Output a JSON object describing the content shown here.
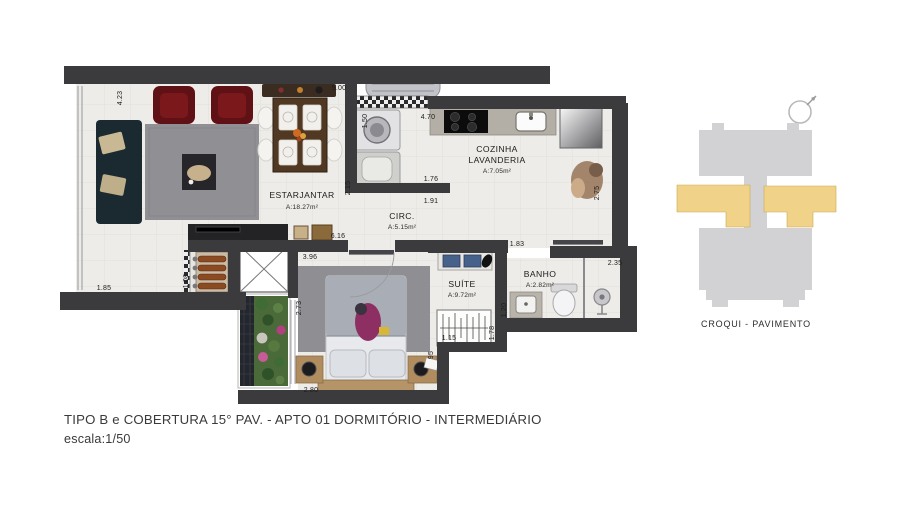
{
  "plan": {
    "rooms": [
      {
        "line1": "ESTARJANTAR",
        "area": "A:18.27m²"
      },
      {
        "line1": "COZINHA",
        "line2": "LAVANDERIA",
        "area": "A:7.05m²"
      },
      {
        "line1": "CIRC.",
        "area": "A:5.15m²"
      },
      {
        "line1": "SUÍTE",
        "area": "A:9.72m²"
      },
      {
        "line1": "BANHO",
        "area": "A:2.82m²"
      }
    ],
    "dims": [
      "4.23",
      "5.00",
      "1.50",
      "4.70",
      "2.15",
      "1.76",
      "1.91",
      "2.75",
      "6.16",
      "1.83",
      "3.96",
      "1.08",
      "1.85",
      "2.73",
      "2.35",
      "1.20",
      "1.78",
      "1.15",
      "95",
      "2.80"
    ]
  },
  "croqui": {
    "label": "CROQUI - PAVIMENTO",
    "building_color": "#d2d2d4",
    "highlight_color": "#f0d289"
  },
  "footer": {
    "line1": "TIPO B e COBERTURA 15° PAV. - APTO 01  DORMITÓRIO - INTERMEDIÁRIO",
    "line2": "escala:1/50"
  },
  "colors": {
    "wall": "#3b3b3d",
    "floor": "#eeece8",
    "dimension_text": "#1f1f1f"
  }
}
